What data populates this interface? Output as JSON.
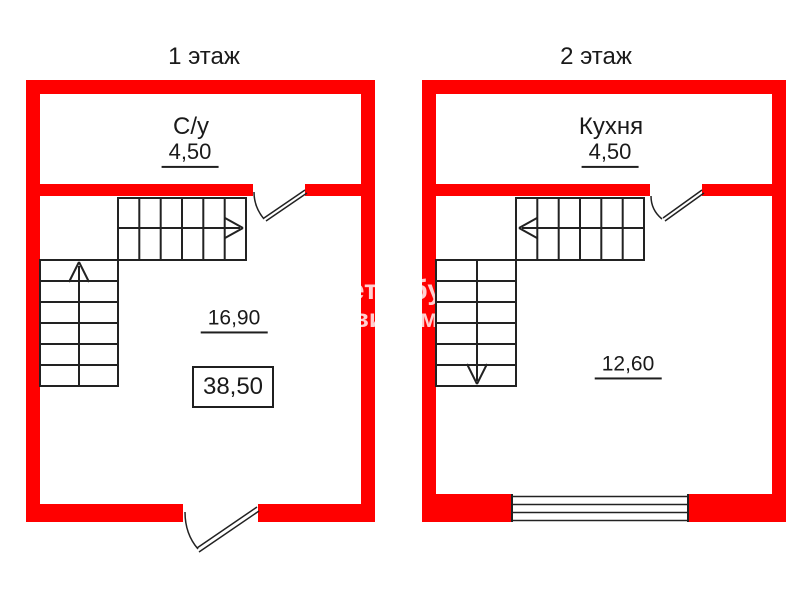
{
  "colors": {
    "wall_red": "#ff0000",
    "line_black": "#222222",
    "watermark_white": "rgba(255,255,255,0.82)"
  },
  "floor1": {
    "title": "1 этаж",
    "bathroom": {
      "name": "С/у",
      "area": "4,50"
    },
    "main_room": {
      "area": "16,90"
    },
    "total_area": "38,50"
  },
  "floor2": {
    "title": "2 этаж",
    "kitchen": {
      "name": "Кухня",
      "area": "4,50"
    },
    "main_room": {
      "area": "12,60"
    }
  },
  "watermark": {
    "line1": "Петербург",
    "line2": "Недвижимость"
  }
}
